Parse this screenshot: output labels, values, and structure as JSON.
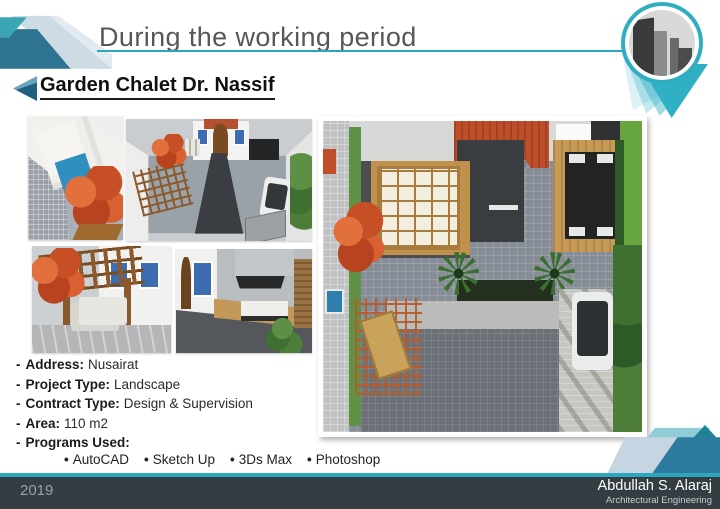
{
  "ui": {
    "dash": "-",
    "bullet": "•"
  },
  "header": {
    "title": "During the working period",
    "subtitle": "Garden Chalet Dr. Nassif"
  },
  "project": {
    "details": [
      {
        "label": "Address:",
        "value": "Nusairat"
      },
      {
        "label": "Project Type:",
        "value": "Landscape"
      },
      {
        "label": "Contract Type:",
        "value": "Design & Supervision"
      },
      {
        "label": "Area:",
        "value": "110 m2"
      },
      {
        "label": "Programs Used:",
        "value": ""
      }
    ],
    "programs": [
      {
        "name": "AutoCAD"
      },
      {
        "name": "Sketch Up"
      },
      {
        "name": "3Ds Max"
      },
      {
        "name": "Photoshop"
      }
    ]
  },
  "footer": {
    "year": "2019",
    "author": "Abdullah S. Alaraj",
    "department": "Architectural Engineering"
  },
  "images": {
    "thumb_pool": "pool-render",
    "thumb_aerial": "garden-aerial-render",
    "thumb_pergola": "pergola-render",
    "thumb_patio": "patio-seating-render",
    "main_plan": "garden-top-view-render",
    "pin_photo": "city-buildings-photo"
  },
  "colors": {
    "accent_teal": "#2BA7BD",
    "steel_blue": "#2E7492",
    "light_blue": "#C9DAE4",
    "footer_dark": "#343D41"
  }
}
